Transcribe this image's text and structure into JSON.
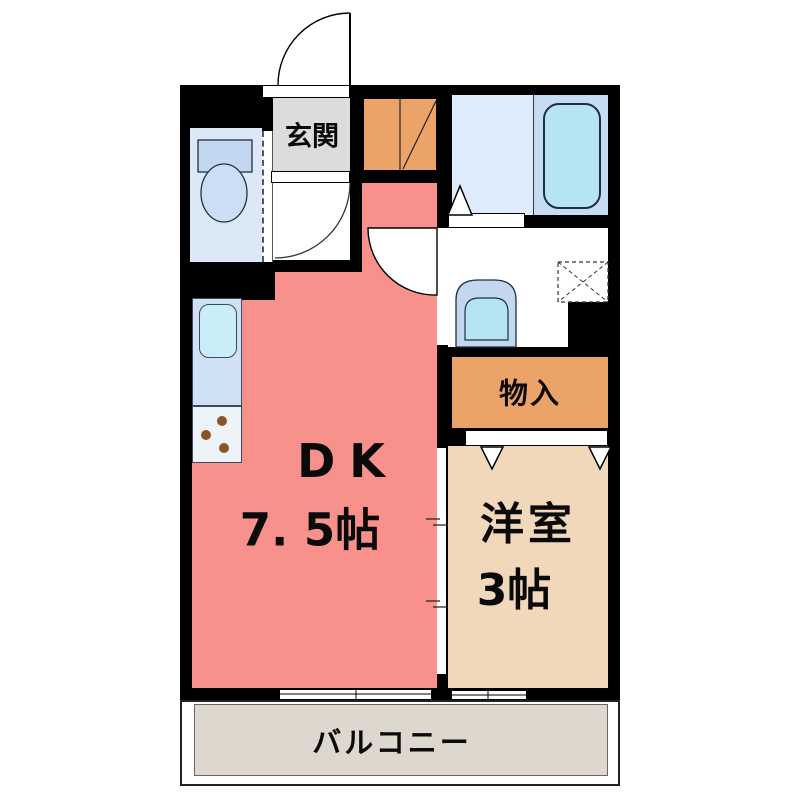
{
  "plan": {
    "rooms": {
      "genkan": {
        "label": "玄関"
      },
      "dining_kitchen": {
        "label": "DK",
        "size": "7. 5帖"
      },
      "storage": {
        "label": "物入"
      },
      "western_room": {
        "label": "洋室",
        "size": "3帖"
      },
      "balcony": {
        "label": "バルコニー"
      }
    },
    "fixtures": [
      "toilet",
      "bathtub",
      "washbasin",
      "washing-machine-pan",
      "kitchen-sink",
      "gas-stove",
      "shoe-cabinet",
      "entrance-door-swing",
      "hallway-door-swing",
      "dk-door-swing",
      "folding-bath-door",
      "closet-sliding-doors",
      "room-sliding-door",
      "sliding-windows",
      "toilet-folding-door"
    ],
    "colors": {
      "wall": "#000000",
      "dk_floor": "#F8918C",
      "western_room_floor": "#F2D8BA",
      "storage_fill": "#EBA368",
      "genkan_floor": "#DCDCDC",
      "wet_area_floor": "#DEEBFA",
      "bathtub_zone": "#C6DCF2",
      "bathtub": "#B5E5F0",
      "fixture_blue": "#C3D8F0",
      "balcony_floor": "#DED7CE"
    }
  }
}
